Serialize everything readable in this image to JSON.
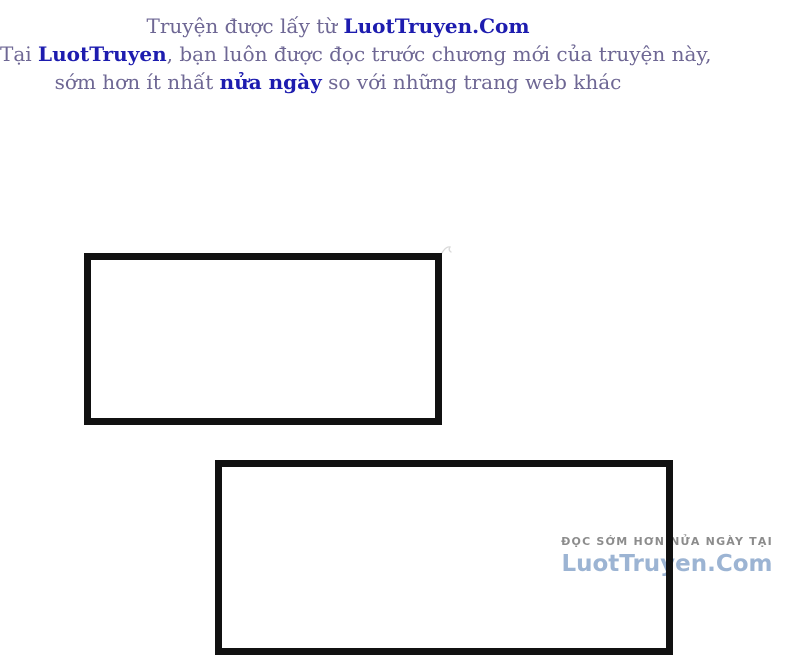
{
  "page": {
    "background_color": "#ffffff",
    "panel_border_color": "#111111"
  },
  "notice": {
    "text_color": "#6e6794",
    "highlight_color": "#1d1caf",
    "line1_prefix": "Truyện được lấy từ ",
    "line1_site": "LuotTruyen.Com",
    "line2_prefix": "Tại ",
    "line2_site": "LuotTruyen",
    "line2_suffix": ", bạn luôn được đọc trước chương mới của truyện này,",
    "line3_prefix": "sớm hơn ít nhất ",
    "line3_highlight": "nửa ngày",
    "line3_suffix": " so với những trang web khác"
  },
  "watermark": {
    "tagline": "ĐỌC SỚM HƠN NỬA NGÀY TẠI",
    "site": "LuotTruyen.Com",
    "tagline_color": "#8c8c8c",
    "site_color": "#9cb4d3"
  }
}
